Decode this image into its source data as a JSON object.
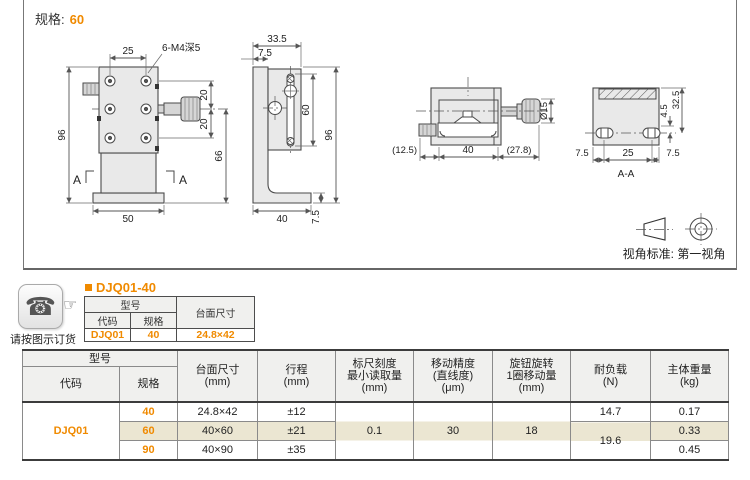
{
  "colors": {
    "accent": "#f08a00",
    "highlight_row": "#ebe6d2",
    "header_bg": "#f0f0ee"
  },
  "drawing": {
    "spec_label": "规格:",
    "spec_value": "60",
    "front": {
      "w25": "25",
      "thread": "6-M4深5",
      "h96": "96",
      "p20a": "20",
      "p20b": "20",
      "h66": "66",
      "w50": "50",
      "secA": "A"
    },
    "side": {
      "w335": "33.5",
      "w75": "7.5",
      "h60": "60",
      "h96": "96",
      "w40": "40",
      "h75": "7.5"
    },
    "top": {
      "w125": "(12.5)",
      "w40": "40",
      "w278": "(27.8)",
      "dia15": "Ø15"
    },
    "section": {
      "h45": "4.5",
      "h325": "32.5",
      "w75l": "7.5",
      "w25": "25",
      "w75r": "7.5",
      "label": "A-A"
    },
    "projection_label": "视角标准: 第一视角"
  },
  "order": {
    "note": "请按图示订货",
    "icons": {
      "phone": "☎",
      "finger": "☞"
    },
    "heading": "DJQ01-40",
    "table": {
      "model": "型号",
      "code": "代码",
      "spec": "规格",
      "size": "台面尺寸",
      "row": {
        "code": "DJQ01",
        "spec": "40",
        "size": "24.8×42"
      }
    }
  },
  "main_table": {
    "headers": {
      "model": "型号",
      "code": "代码",
      "spec": "规格",
      "size": "台面尺寸\n(mm)",
      "stroke": "行程\n(mm)",
      "scale": "标尺刻度\n最小读取量\n(mm)",
      "accuracy": "移动精度\n(直线度)\n(μm)",
      "knob": "旋钮旋转\n1圈移动量\n(mm)",
      "load": "耐负载\n(N)",
      "weight": "主体重量\n(kg)"
    },
    "code_value": "DJQ01",
    "rows": [
      {
        "spec": "40",
        "size": "24.8×42",
        "stroke": "±12",
        "load": "14.7",
        "weight": "0.17"
      },
      {
        "spec": "60",
        "size": "40×60",
        "stroke": "±21",
        "weight": "0.33"
      },
      {
        "spec": "90",
        "size": "40×90",
        "stroke": "±35",
        "weight": "0.45"
      }
    ],
    "merged": {
      "scale": "0.1",
      "accuracy": "30",
      "knob": "18",
      "load": "19.6"
    }
  }
}
